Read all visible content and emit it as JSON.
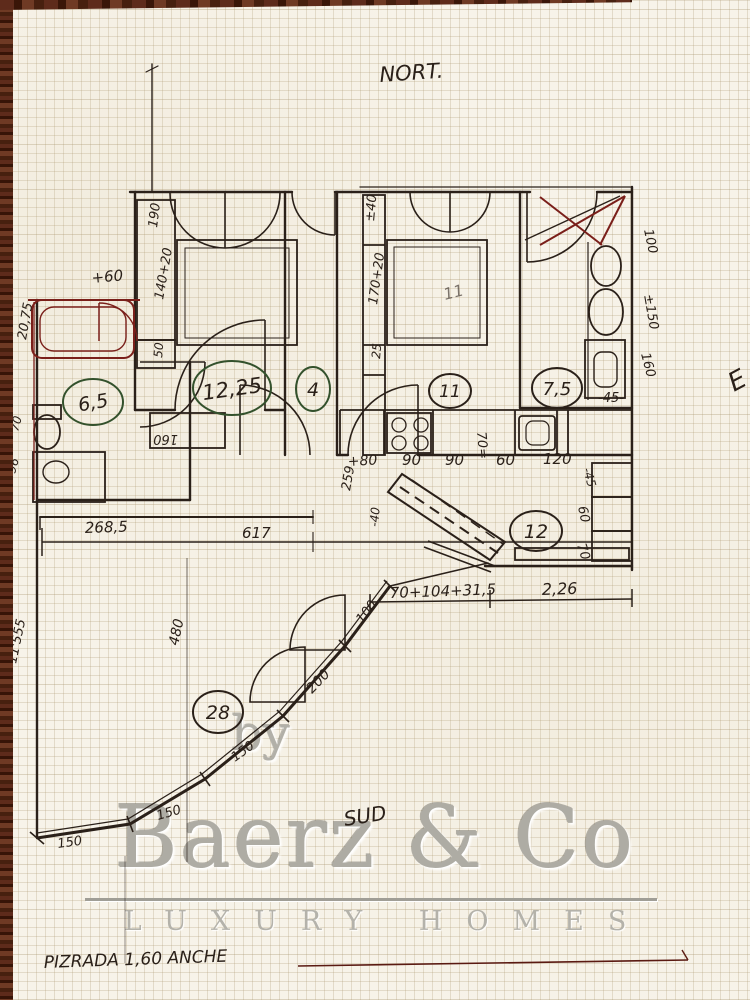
{
  "compass": {
    "north": "NORT.",
    "south": "SUD",
    "east_partial": "E"
  },
  "watermark": {
    "by": "by",
    "brand": "Baerz & Co",
    "tagline": "LUXURY HOMES"
  },
  "note": "PIZRADA 1,60 ANCHE",
  "rooms": [
    {
      "name": "bathroom-left",
      "area": "6,5"
    },
    {
      "name": "bedroom-left",
      "area": "12,25"
    },
    {
      "name": "hall",
      "area": "4"
    },
    {
      "name": "bedroom-right",
      "area": "11"
    },
    {
      "name": "bathroom-right",
      "area": "7,5"
    },
    {
      "name": "kitchen-dining",
      "area": "12"
    },
    {
      "name": "terrace",
      "area": "28"
    }
  ],
  "labels": {
    "wardrobe_190": "190",
    "bed1_140": "140+20",
    "box_50": "50",
    "plus_60": "+60",
    "closet_160": "160",
    "bed2_pencil": "11",
    "w2_40": "±40",
    "w2_170": "170+20",
    "w2_25": "25",
    "right_100": "100",
    "right_150": "±150",
    "right_160": "160",
    "bath_45": "-45-",
    "k_80": "+80",
    "k_90a": "90",
    "k_90b": "90",
    "k_60": "60",
    "k_120": "120",
    "k_70": "70=",
    "r12_45": "-45",
    "r12_60": "60",
    "r12_70": "70",
    "dim_70_104": "70+104+31,5",
    "dim_226": "2,26",
    "left_2075": "20,75",
    "left_70": "70",
    "left_96": "96",
    "left_555": "11'555",
    "dim_2685": "268,5",
    "dim_617": "617",
    "dim_259": "259",
    "dim_neg40": "-40",
    "t_480": "480",
    "t_150a": "150",
    "t_150b": "150",
    "t_150c": "150",
    "t_200": "200",
    "t_100": "100"
  },
  "colors": {
    "ink": "#2a2019",
    "red_ink": "#7a1f1a",
    "green_ink": "#33512c",
    "watermark": "#aeaca4",
    "wood": "#4a2014",
    "paper": "#f7f3e9"
  }
}
